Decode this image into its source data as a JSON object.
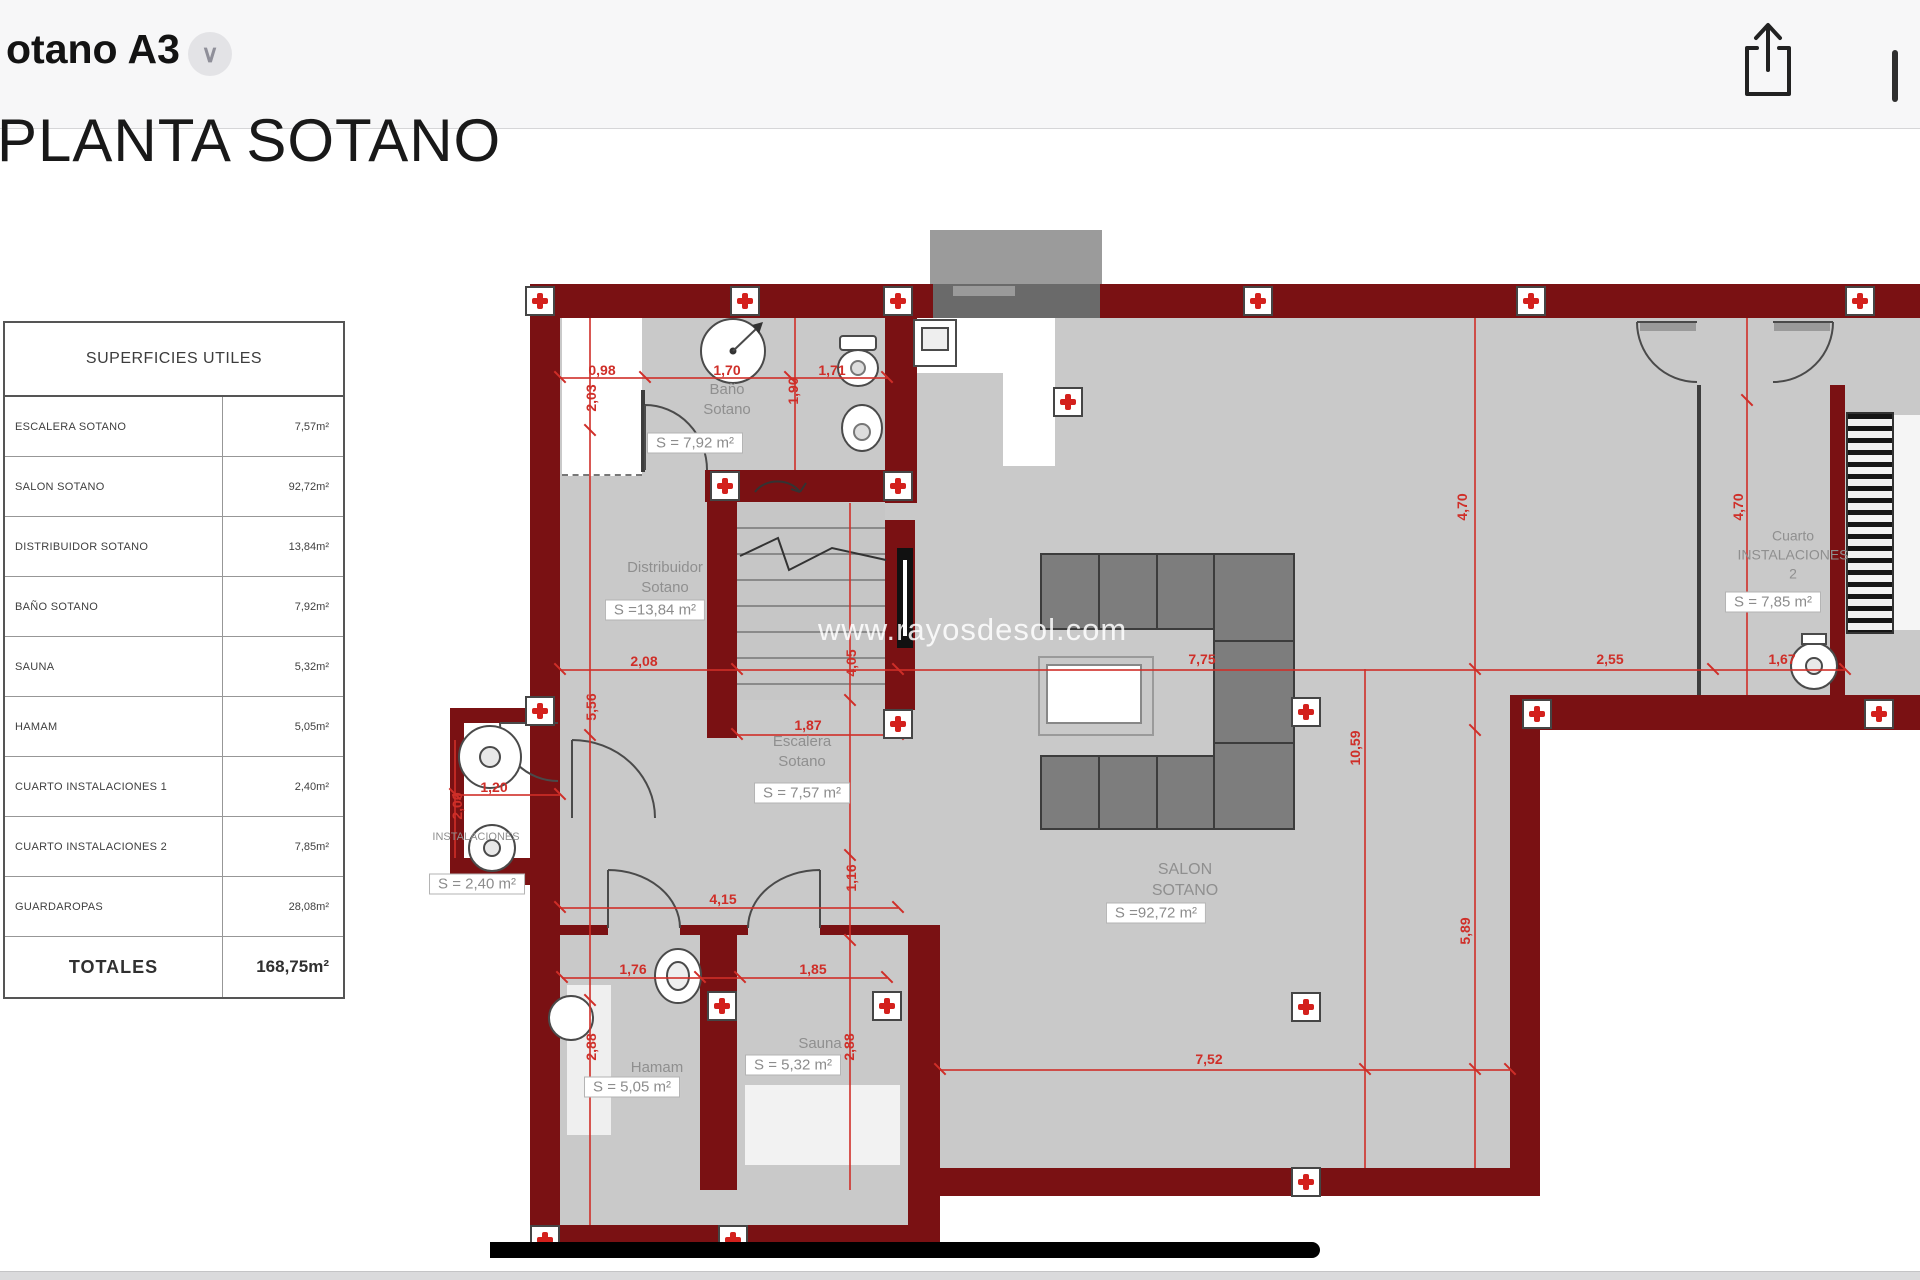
{
  "topbar": {
    "title": "otano A3",
    "chevron_glyph": "∨"
  },
  "document": {
    "title": "PLANTA SOTANO",
    "watermark": "www.rayosdesol.com"
  },
  "surfaces_table": {
    "title": "SUPERFICIES UTILES",
    "rows": [
      {
        "label": "ESCALERA SOTANO",
        "value": "7,57m²"
      },
      {
        "label": "SALON SOTANO",
        "value": "92,72m²"
      },
      {
        "label": "DISTRIBUIDOR SOTANO",
        "value": "13,84m²"
      },
      {
        "label": "BAÑO SOTANO",
        "value": "7,92m²"
      },
      {
        "label": "SAUNA",
        "value": "5,32m²"
      },
      {
        "label": "HAMAM",
        "value": "5,05m²"
      },
      {
        "label": "CUARTO INSTALACIONES 1",
        "value": "2,40m²"
      },
      {
        "label": "CUARTO INSTALACIONES 2",
        "value": "7,85m²"
      },
      {
        "label": "GUARDAROPAS",
        "value": "28,08m²"
      }
    ],
    "total": {
      "label": "TOTALES",
      "value": "168,75m²"
    }
  },
  "plan": {
    "colors": {
      "wall": "#7a1113",
      "floor": "#c9c9c9",
      "dimension": "#cf2e28",
      "room_label": "#8f8f8f"
    },
    "room_labels": [
      {
        "lines": [
          "Baño",
          "Sotano"
        ],
        "x": 727,
        "y": 400,
        "size": 15
      },
      {
        "lines": [
          "Distribuidor",
          "Sotano"
        ],
        "x": 665,
        "y": 578,
        "size": 15
      },
      {
        "lines": [
          "Escalera",
          "Sotano"
        ],
        "x": 802,
        "y": 752,
        "size": 15
      },
      {
        "lines": [
          "SALON",
          "SOTANO"
        ],
        "x": 1185,
        "y": 880,
        "size": 16
      },
      {
        "lines": [
          "Sauna"
        ],
        "x": 820,
        "y": 1044,
        "size": 15
      },
      {
        "lines": [
          "Hamam"
        ],
        "x": 657,
        "y": 1068,
        "size": 15
      },
      {
        "lines": [
          "INSTALACIONES"
        ],
        "x": 476,
        "y": 837,
        "size": 11
      },
      {
        "lines": [
          "Cuarto",
          "INSTALACIONES",
          "2"
        ],
        "x": 1793,
        "y": 555,
        "size": 14
      }
    ],
    "area_tags": [
      {
        "text": "S = 7,92 m²",
        "x": 695,
        "y": 443
      },
      {
        "text": "S =13,84 m²",
        "x": 655,
        "y": 610
      },
      {
        "text": "S = 7,57 m²",
        "x": 802,
        "y": 793
      },
      {
        "text": "S =92,72 m²",
        "x": 1156,
        "y": 913
      },
      {
        "text": "S = 5,32 m²",
        "x": 793,
        "y": 1065
      },
      {
        "text": "S = 5,05 m²",
        "x": 632,
        "y": 1087
      },
      {
        "text": "S = 2,40 m²",
        "x": 477,
        "y": 884
      },
      {
        "text": "S = 7,85 m²",
        "x": 1773,
        "y": 602
      }
    ],
    "dim_labels": [
      {
        "text": "0,98",
        "x": 602,
        "y": 370,
        "rot": 0
      },
      {
        "text": "1,70",
        "x": 727,
        "y": 370,
        "rot": 0
      },
      {
        "text": "1,71",
        "x": 832,
        "y": 370,
        "rot": 0
      },
      {
        "text": "2,03",
        "x": 591,
        "y": 398,
        "rot": -90
      },
      {
        "text": "1,90",
        "x": 793,
        "y": 391,
        "rot": -90
      },
      {
        "text": "2,08",
        "x": 644,
        "y": 661,
        "rot": 0
      },
      {
        "text": "7,75",
        "x": 1202,
        "y": 659,
        "rot": 0
      },
      {
        "text": "2,55",
        "x": 1610,
        "y": 659,
        "rot": 0
      },
      {
        "text": "1,67",
        "x": 1782,
        "y": 659,
        "rot": 0
      },
      {
        "text": "5,56",
        "x": 591,
        "y": 707,
        "rot": -90
      },
      {
        "text": "4,05",
        "x": 851,
        "y": 663,
        "rot": -90
      },
      {
        "text": "4,70",
        "x": 1462,
        "y": 507,
        "rot": -90
      },
      {
        "text": "4,70",
        "x": 1738,
        "y": 507,
        "rot": -90
      },
      {
        "text": "1,87",
        "x": 808,
        "y": 725,
        "rot": 0
      },
      {
        "text": "1,20",
        "x": 494,
        "y": 787,
        "rot": 0
      },
      {
        "text": "2,00",
        "x": 457,
        "y": 806,
        "rot": -90
      },
      {
        "text": "4,15",
        "x": 723,
        "y": 899,
        "rot": 0
      },
      {
        "text": "1,16",
        "x": 851,
        "y": 878,
        "rot": -90
      },
      {
        "text": "1,76",
        "x": 633,
        "y": 969,
        "rot": 0
      },
      {
        "text": "1,85",
        "x": 813,
        "y": 969,
        "rot": 0
      },
      {
        "text": "2,88",
        "x": 591,
        "y": 1047,
        "rot": -90
      },
      {
        "text": "2,88",
        "x": 849,
        "y": 1047,
        "rot": -90
      },
      {
        "text": "10,59",
        "x": 1355,
        "y": 748,
        "rot": -90
      },
      {
        "text": "5,89",
        "x": 1465,
        "y": 931,
        "rot": -90
      },
      {
        "text": "7,52",
        "x": 1209,
        "y": 1059,
        "rot": 0
      }
    ],
    "dim_lines": [
      [
        560,
        377,
        327,
        2
      ],
      [
        560,
        669,
        1285,
        2
      ],
      [
        560,
        907,
        338,
        2
      ],
      [
        562,
        977,
        325,
        2
      ],
      [
        940,
        1069,
        570,
        2
      ],
      [
        737,
        734,
        161,
        2
      ],
      [
        452,
        794,
        108,
        2
      ],
      [
        589,
        318,
        2,
        907
      ],
      [
        794,
        318,
        2,
        152
      ],
      [
        849,
        503,
        2,
        687
      ],
      [
        1364,
        669,
        2,
        499
      ],
      [
        1474,
        318,
        2,
        850
      ],
      [
        1746,
        318,
        2,
        377
      ],
      [
        454,
        740,
        2,
        118
      ]
    ],
    "ticks": [
      [
        560,
        377
      ],
      [
        645,
        377
      ],
      [
        790,
        377
      ],
      [
        887,
        377
      ],
      [
        560,
        669
      ],
      [
        737,
        669
      ],
      [
        898,
        669
      ],
      [
        1475,
        669
      ],
      [
        1713,
        669
      ],
      [
        1845,
        669
      ],
      [
        560,
        907
      ],
      [
        898,
        907
      ],
      [
        562,
        977
      ],
      [
        700,
        977
      ],
      [
        740,
        977
      ],
      [
        887,
        977
      ],
      [
        940,
        1069
      ],
      [
        1510,
        1069
      ],
      [
        1365,
        1069
      ],
      [
        1475,
        1069
      ],
      [
        737,
        734
      ],
      [
        898,
        734
      ],
      [
        455,
        794
      ],
      [
        560,
        794
      ],
      [
        590,
        430
      ],
      [
        590,
        735
      ],
      [
        590,
        1000
      ],
      [
        850,
        700
      ],
      [
        850,
        855
      ],
      [
        850,
        940
      ],
      [
        1475,
        730
      ],
      [
        1747,
        400
      ]
    ],
    "pillars": [
      [
        540,
        301
      ],
      [
        745,
        301
      ],
      [
        898,
        301
      ],
      [
        1258,
        301
      ],
      [
        1531,
        301
      ],
      [
        1860,
        301
      ],
      [
        540,
        711
      ],
      [
        725,
        486
      ],
      [
        898,
        486
      ],
      [
        898,
        724
      ],
      [
        1068,
        402
      ],
      [
        1306,
        712
      ],
      [
        1537,
        714
      ],
      [
        1879,
        714
      ],
      [
        722,
        1006
      ],
      [
        887,
        1006
      ],
      [
        1306,
        1007
      ],
      [
        1306,
        1182
      ],
      [
        545,
        1240
      ],
      [
        733,
        1240
      ]
    ]
  }
}
